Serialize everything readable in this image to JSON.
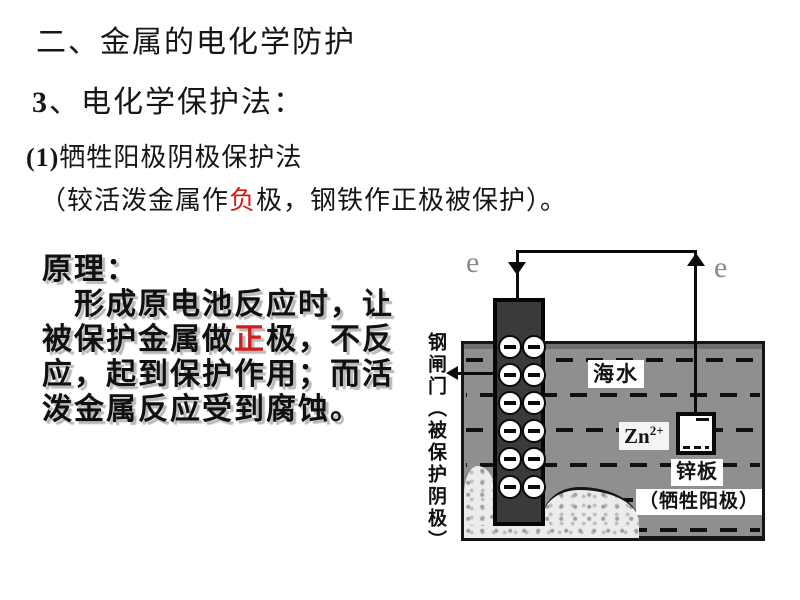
{
  "colors": {
    "background": "#ffffff",
    "text": "#161616",
    "accent_red": "#cf1d1d",
    "sea_gray": "#8f8f8f",
    "electrode_dark": "#3a3a3a",
    "electron_gray": "#8a8a8a",
    "rock_light": "#ececec"
  },
  "heading": {
    "line1": "二、金属的电化学防护",
    "line2_num": "3",
    "line2_rest": "、电化学保护法：",
    "line3_num": "(1)",
    "line3_rest": "牺牲阳极阴极保护法",
    "line4_pre": "（较活泼金属作",
    "line4_red": "负",
    "line4_post": "极，钢铁作正极被保护）。"
  },
  "principle": {
    "label": "原理：",
    "line2": "形成原电池反应时，让",
    "line3_pre": "被保护金属做",
    "line3_red": "正",
    "line3_post": "极，不反",
    "line4": "应，起到保护作用；而活",
    "line5": "泼金属反应受到腐蚀。"
  },
  "diagram": {
    "electron_left": "e",
    "electron_right": "e",
    "seawater_label": "海水",
    "ion_base": "Zn",
    "ion_sup": "2+",
    "zinc_plate_label": "锌板",
    "sacrificial_label": "（牺牲阳极）",
    "gate_label": "钢闸门（被保护阴极）"
  }
}
